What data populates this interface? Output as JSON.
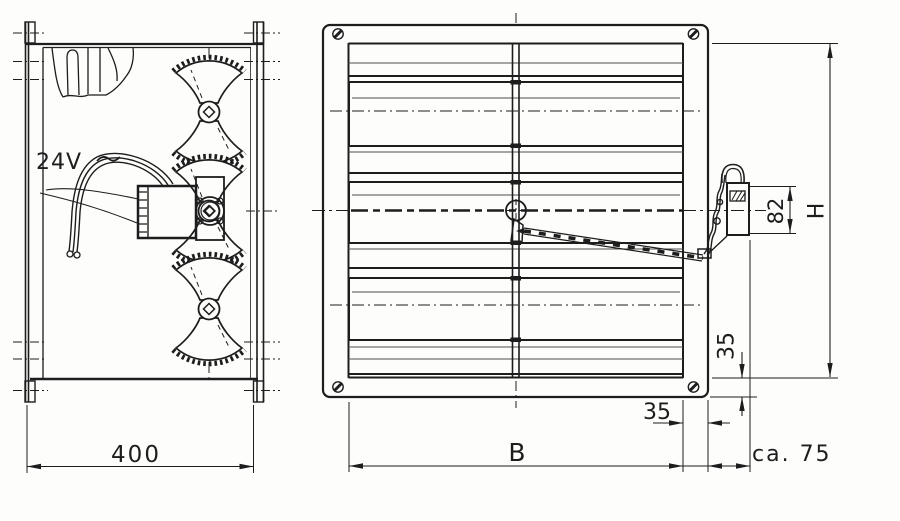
{
  "colors": {
    "ink": "#1d1d1d",
    "ink_light": "#4d4d4d",
    "paper": "#fdfdfc"
  },
  "side_view": {
    "power_label": "24V",
    "width_dim": "400"
  },
  "front_view": {
    "width_dim": "B",
    "height_dim": "H",
    "actuator_height_dim": "82",
    "frame_depth_dim": "35",
    "frame_width_dim": "35",
    "actuator_depth_dim": "ca. 75"
  }
}
